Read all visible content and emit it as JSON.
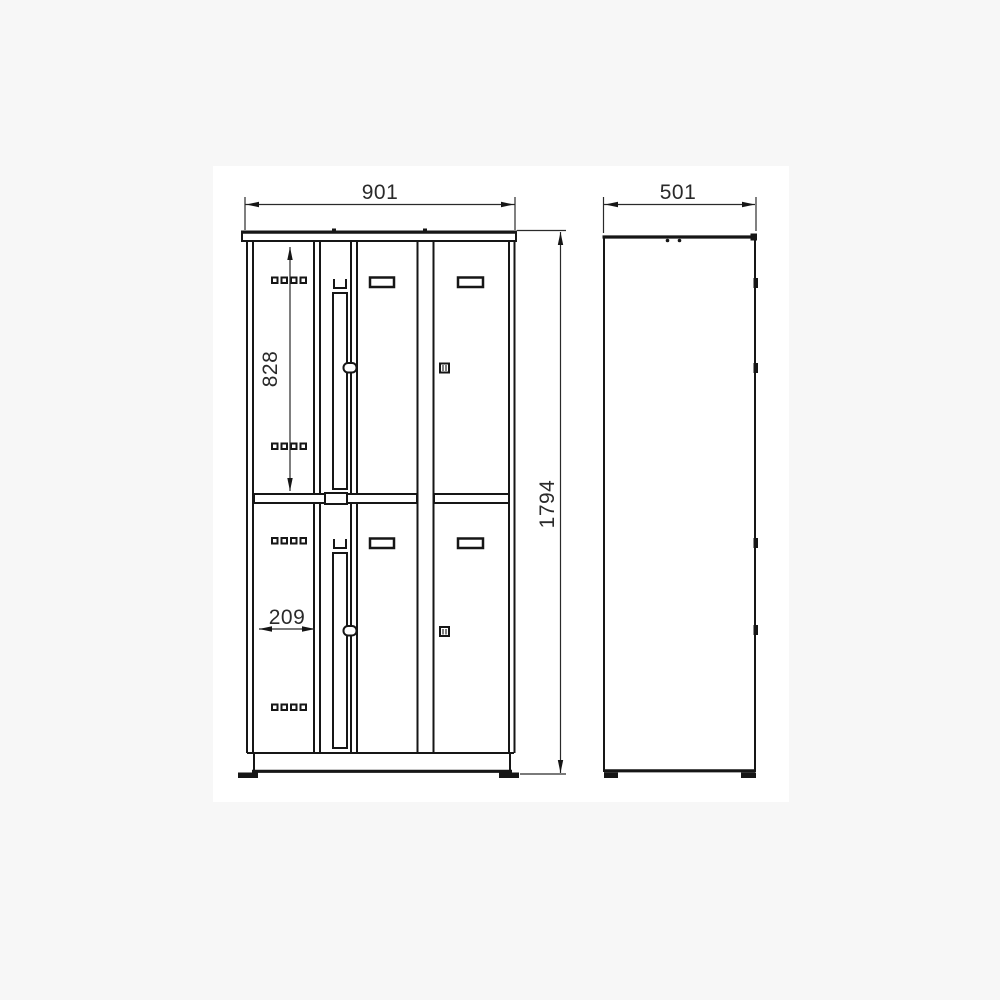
{
  "dims": {
    "width": "901",
    "depth": "501",
    "height": "1794",
    "upper_compartment_height": "828",
    "left_compartment_width": "209"
  },
  "style": {
    "background": "#f7f7f7",
    "paper": "#ffffff",
    "line_color": "#161616",
    "dim_text_color": "#2a2a2a"
  }
}
